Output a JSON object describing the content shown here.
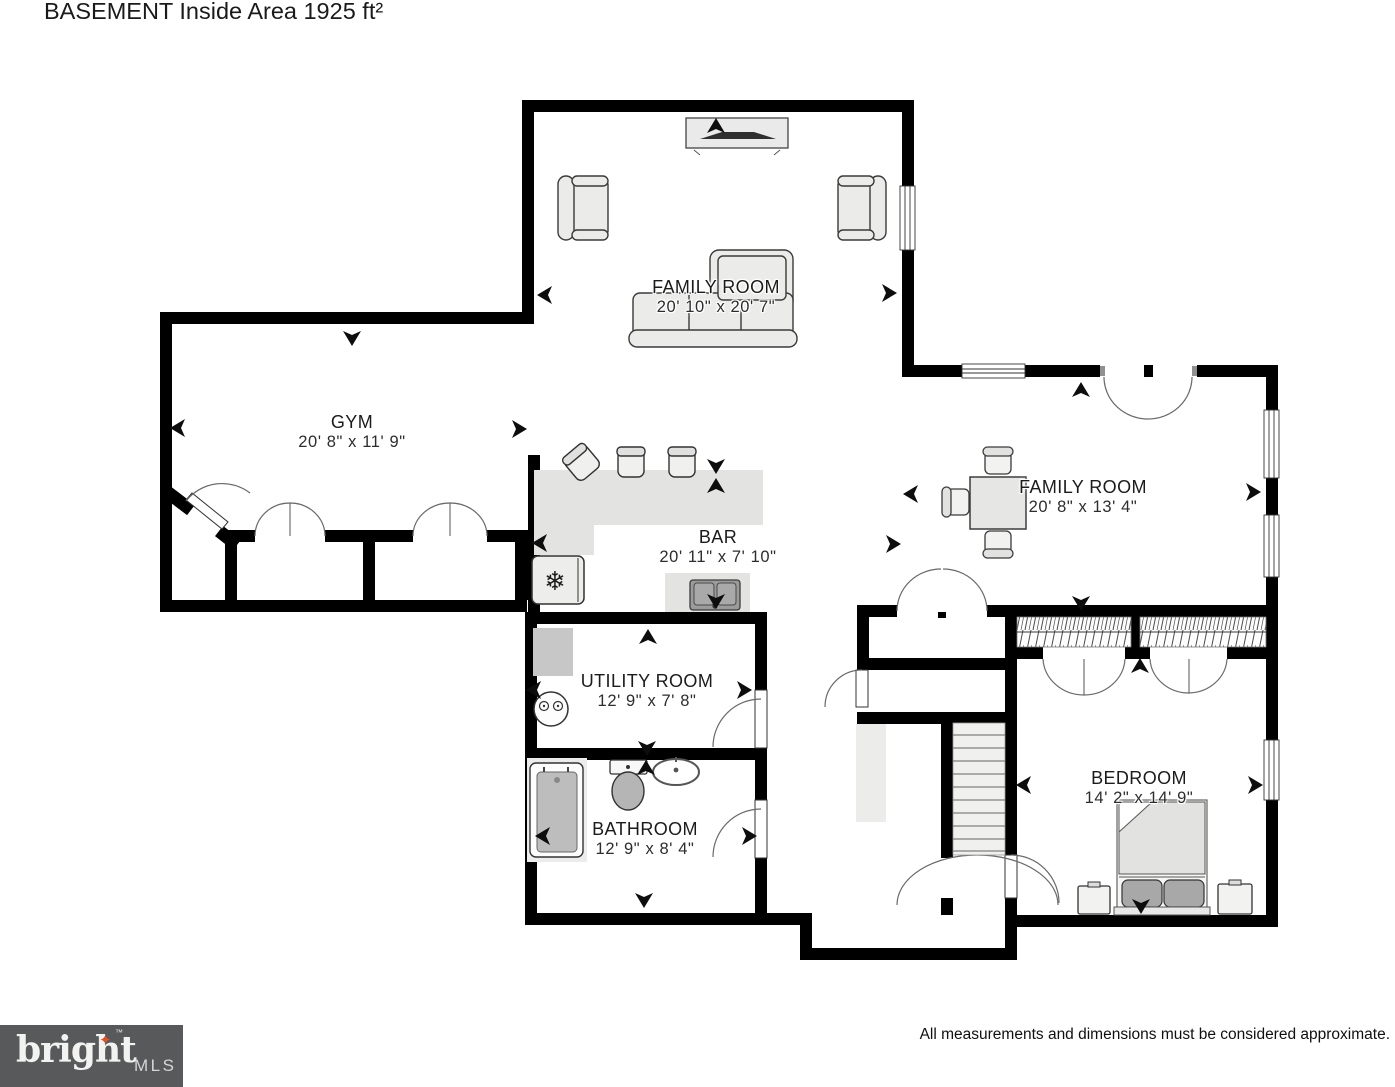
{
  "page": {
    "title": "BASEMENT Inside Area 1925 ft²"
  },
  "rooms": [
    {
      "key": "family-room-upper",
      "label": "FAMILY ROOM",
      "dims": "20' 10\" x 20' 7\""
    },
    {
      "key": "gym",
      "label": "GYM",
      "dims": "20' 8\" x 11' 9\""
    },
    {
      "key": "bar",
      "label": "BAR",
      "dims": "20' 11\" x 7' 10\""
    },
    {
      "key": "family-room-lower",
      "label": "FAMILY ROOM",
      "dims": "20' 8\" x 13' 4\""
    },
    {
      "key": "utility-room",
      "label": "UTILITY ROOM",
      "dims": "12' 9\" x 7' 8\""
    },
    {
      "key": "bathroom",
      "label": "BATHROOM",
      "dims": "12' 9\" x 8' 4\""
    },
    {
      "key": "bedroom",
      "label": "BEDROOM",
      "dims": "14' 2\" x 14' 9\""
    }
  ],
  "icons": {
    "freezer_glyph": "❄"
  },
  "footer": {
    "disclaimer": "All measurements and dimensions must be considered approximate.",
    "logo": {
      "word": "bright",
      "suffix": "MLS",
      "trademark": "™",
      "star_glyph": "✦",
      "bg_color": "#58595b",
      "star_color": "#d9532b"
    }
  },
  "colors": {
    "wall": "#000000",
    "furniture_fill": "#ebebe9",
    "counter_fill": "#e3e3e1",
    "fixture_gray": "#bdbdbd",
    "label_text": "#1b1b1b"
  }
}
